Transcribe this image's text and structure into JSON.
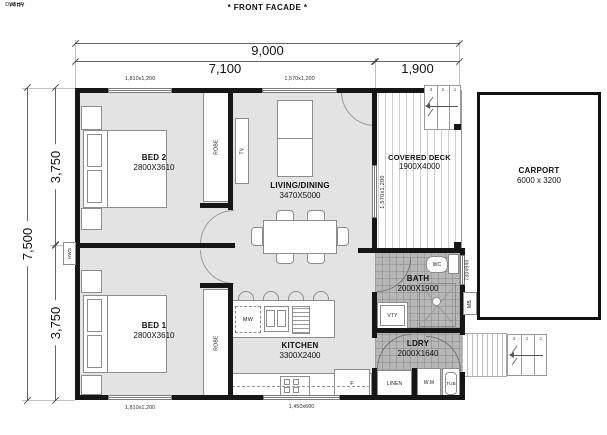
{
  "title": "* FRONT FACADE *",
  "dimensions": {
    "overall_width": "9,000",
    "house_width": "7,100",
    "deck_width": "1,900",
    "overall_depth": "7,500",
    "depth_top": "3,750",
    "depth_bottom": "3,750"
  },
  "rooms": {
    "bed2": {
      "name": "BED 2",
      "size": "2800X3610"
    },
    "living": {
      "name": "LIVING/DINING",
      "size": "3470X5000"
    },
    "deck": {
      "name": "COVERED DECK",
      "size": "1900X4000"
    },
    "carport": {
      "name": "CARPORT",
      "size": "6000 x 3200"
    },
    "bed1": {
      "name": "BED 1",
      "size": "2800X3610"
    },
    "kitchen": {
      "name": "KITCHEN",
      "size": "3300X2400"
    },
    "bath": {
      "name": "BATH",
      "size": "2000X1900"
    },
    "ldry": {
      "name": "LDRY",
      "size": "2000X1640"
    }
  },
  "fixtures": {
    "robe_bed2": "ROBE",
    "robe_bed1": "ROBE",
    "tv": "TV",
    "hws": "HWS",
    "mb": "MB",
    "wc": "WC",
    "shr": "SHR",
    "vty": "VTY",
    "mw": "MW",
    "dw": "DW",
    "ptry": "PTRY",
    "fridge": "F",
    "linen": "LINEN",
    "wm": "W.M",
    "tub": "TUB"
  },
  "windows": {
    "bed2_top": "1,810x1,200",
    "living_top": "1,570x1,200",
    "living_deck": "1,570x1,200",
    "bath_side": "730x940",
    "kitchen_bottom": "1,450x600",
    "bed1_bottom": "1,810x1,200"
  },
  "stairs": {
    "deck": [
      "3",
      "2",
      "1"
    ],
    "rear": [
      "3",
      "2",
      "1"
    ]
  },
  "colors": {
    "wall": "#161616",
    "floor": "#e3e3e3",
    "wet_floor": "#b7b7b7",
    "furniture_line": "#8d8d8d"
  }
}
